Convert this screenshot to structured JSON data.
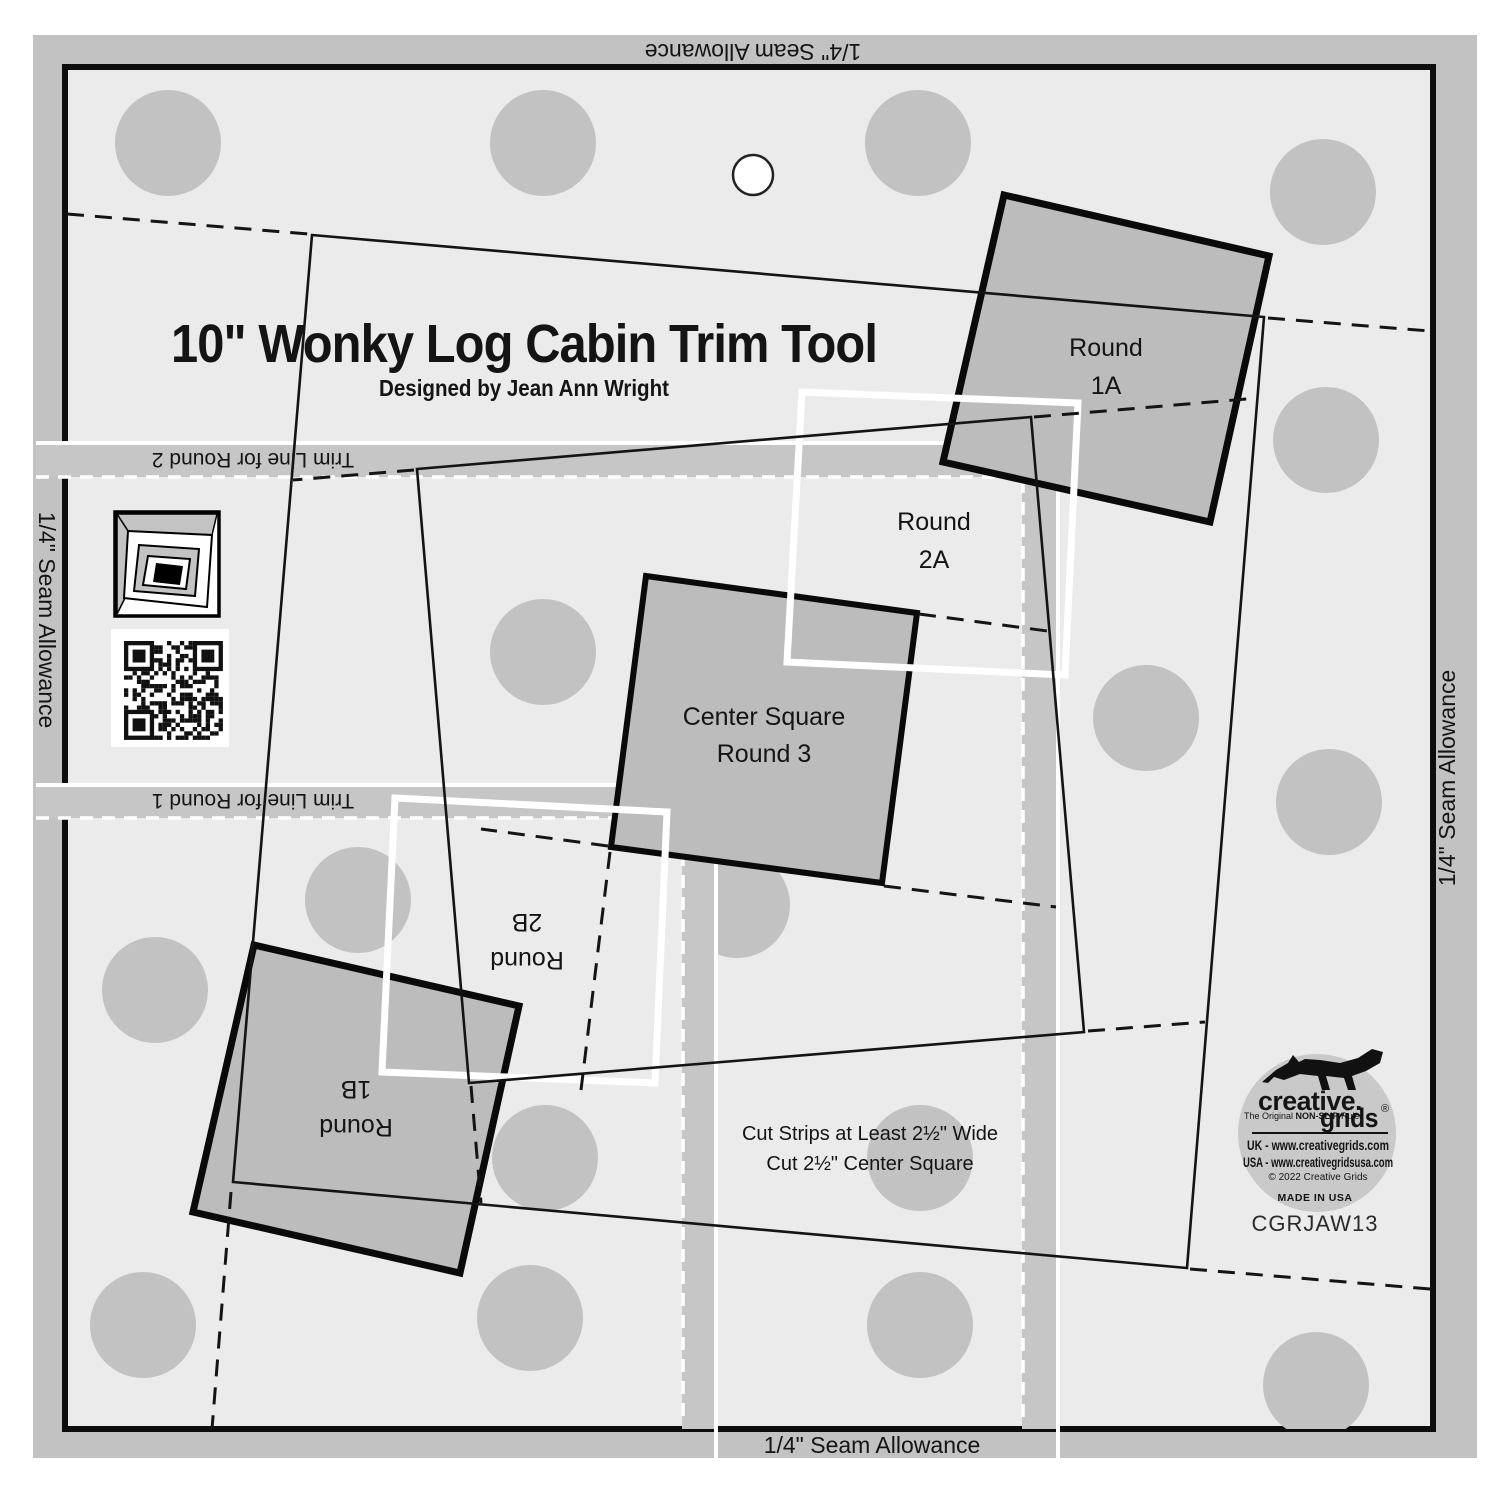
{
  "title": "10\" Wonky Log Cabin Trim Tool",
  "subtitle": "Designed by Jean Ann Wright",
  "seam": {
    "label": "1/4\" Seam Allowance"
  },
  "trim": {
    "round2": "Trim Line for Round 2",
    "round1": "Trim Line for Round 1"
  },
  "squares": {
    "round1a": {
      "line1": "Round",
      "line2": "1A"
    },
    "round2a": {
      "line1": "Round",
      "line2": "2A"
    },
    "center": {
      "line1": "Center Square",
      "line2": "Round 3"
    },
    "round2b": {
      "line1": "Round",
      "line2": "2B"
    },
    "round1b": {
      "line1": "Round",
      "line2": "1B"
    }
  },
  "instructions": {
    "line1": "Cut Strips at Least 2½\" Wide",
    "line2": "Cut 2½\" Center Square"
  },
  "logo": {
    "brand_line1": "creative.",
    "brand_line2": "grids",
    "registered": "®",
    "tagline_a": "The Original ",
    "tagline_b": "NON-SLIP",
    "tagline_c": " Ruler",
    "uk": "UK - www.creativegrids.com",
    "usa": "USA - www.creativegridsusa.com",
    "copyright": "© 2022 Creative Grids",
    "made_in": "MADE IN USA"
  },
  "product_code": "CGRJAW13",
  "colors": {
    "body": "#ebebeb",
    "frame_band": "#c2c2c2",
    "trim_band": "#c6c6c6",
    "dot": "#c2c2c2",
    "square_fill": "#bcbcbc",
    "ink": "#111111",
    "white": "#ffffff"
  }
}
